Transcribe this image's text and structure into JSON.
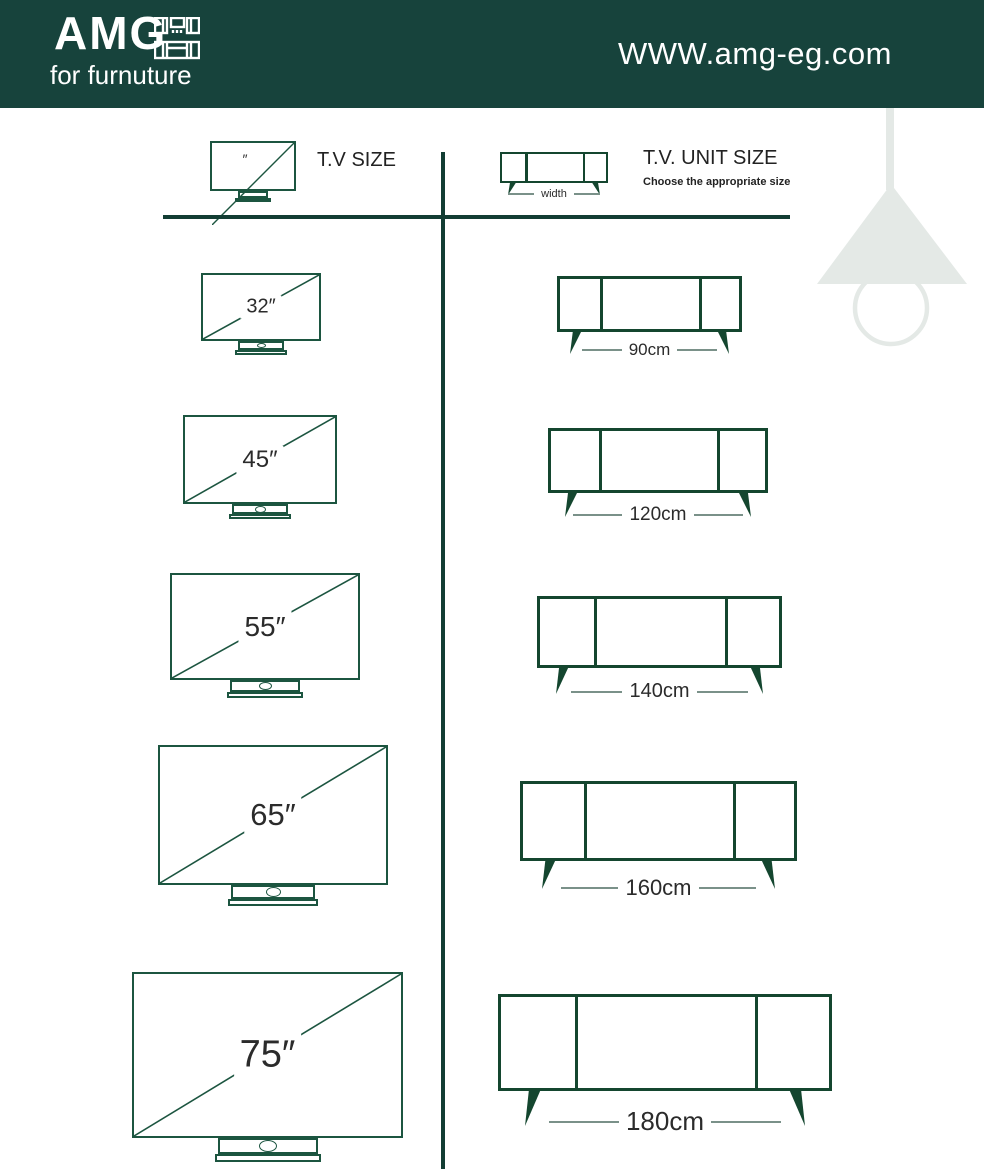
{
  "header": {
    "logo_text": "AMG",
    "logo_subtext": "for furnuture",
    "website": "WWW.amg-eg.com"
  },
  "left_column": {
    "title": "T.V SIZE",
    "icon_mark": "″"
  },
  "right_column": {
    "title": "T.V. UNIT SIZE",
    "subtitle": "Choose the appropriate size",
    "width_label": "width"
  },
  "rows": [
    {
      "tv_label": "32″",
      "unit_label": "90cm"
    },
    {
      "tv_label": "45″",
      "unit_label": "120cm"
    },
    {
      "tv_label": "55″",
      "unit_label": "140cm"
    },
    {
      "tv_label": "65″",
      "unit_label": "160cm"
    },
    {
      "tv_label": "75″",
      "unit_label": "180cm"
    }
  ],
  "colors": {
    "header_bg": "#17433C",
    "tv_line_green": "#1C5540",
    "unit_line_green": "#14462F",
    "divider_green": "#123D33",
    "label_text": "#2B2B2B",
    "dash_gray": "#7A9189",
    "lamp_gray": "#E4E9E6"
  }
}
